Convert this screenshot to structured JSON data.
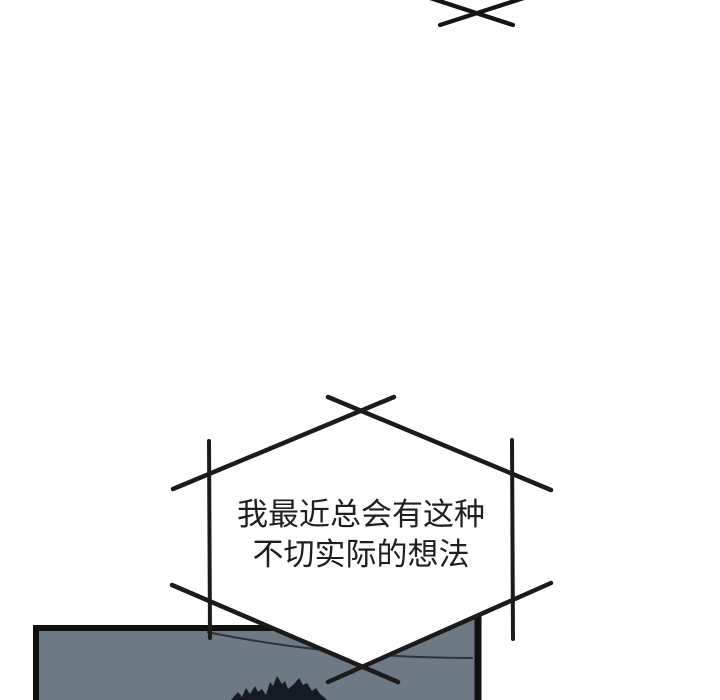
{
  "canvas": {
    "width": 720,
    "height": 700,
    "background_color": "#ffffff"
  },
  "offpanel_bubble_tip": {
    "line_color": "#151515"
  },
  "speech_bubble": {
    "text_lines": {
      "0": "我最近总会有这种",
      "1": "不切实际的想法"
    },
    "fill_color": "#ffffff",
    "outline_color": "#1b1b1b",
    "text_color": "#1f1f1f"
  },
  "scene_panel": {
    "fill_color": "#6d7984",
    "border_color": "#101010",
    "ceiling_line_color": "#2b323c",
    "hair_silhouette_color": "#151a23"
  }
}
